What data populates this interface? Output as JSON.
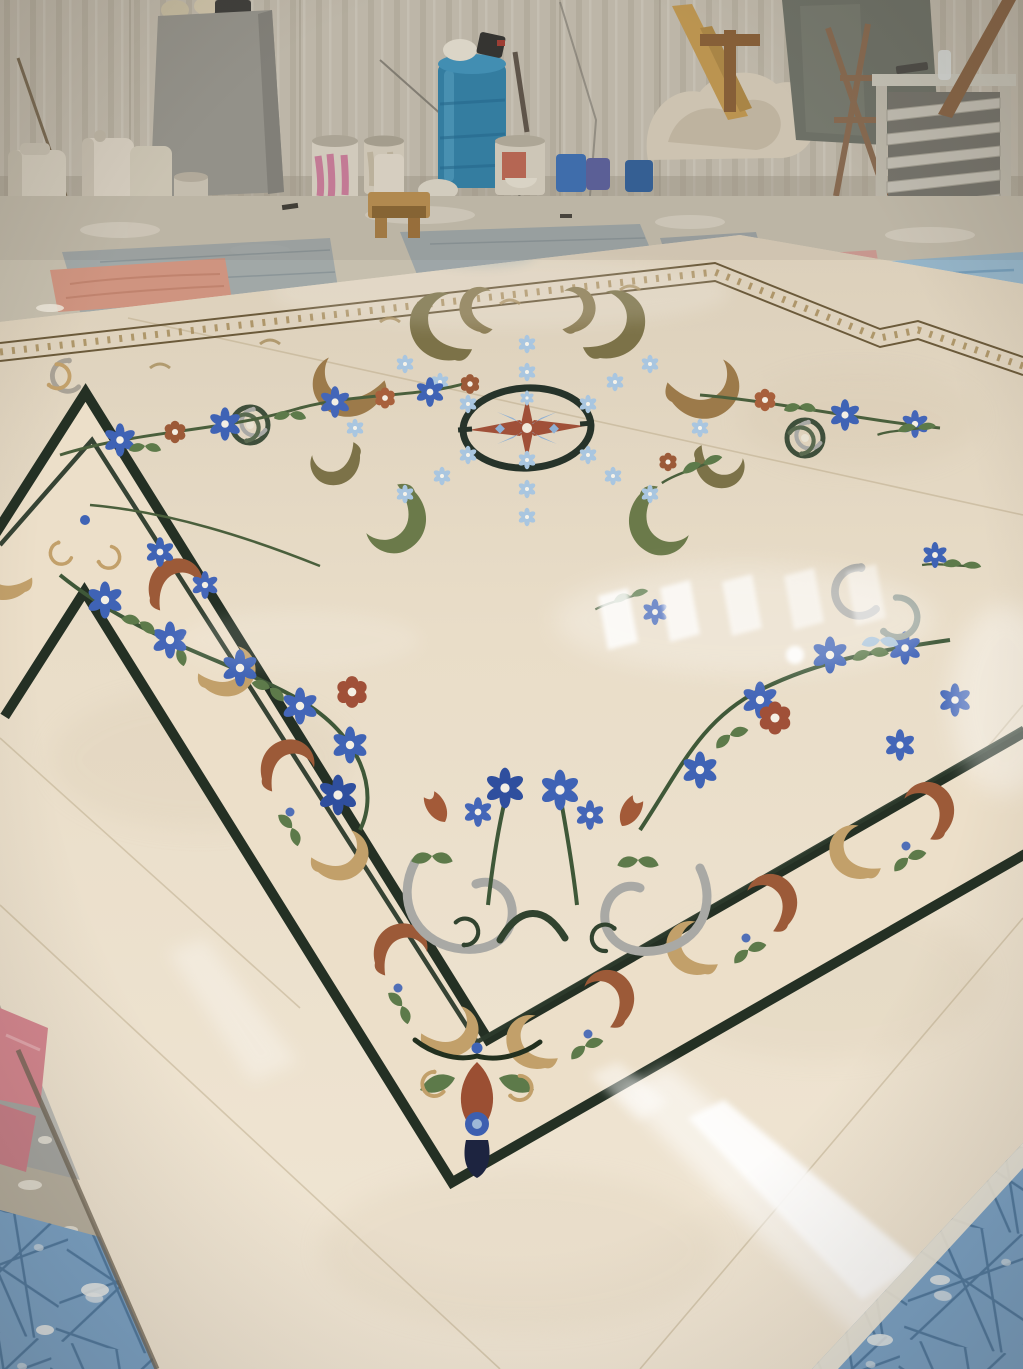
{
  "meta": {
    "domain": "photograph",
    "title": "Waterjet marble inlay medallion floor in a stone workshop",
    "description": "A large freshly polished crema-marfil marble floor with an ornate waterjet inlay — a stepped dark-green border frame filled with rust and tan acanthus scrolls, a central compass medallion ringed by an olive scroll wreath with pale blue rosettes, and a floral garland of blue daisies, rust flowers and gray baroque scrolls. The slab reflects overhead windows. Around it is a dusty workshop: corrugated sheet walls, a concrete slab, white jerry cans, paint buckets with pink drips, a blue plastic barrel, a wooden stool, lumber, a steel drying rack, gray quilted mats, a salmon cushion, light blue and pink cloths, blue cross-hatched protective tarps and pink foam sheets at the slab edges."
  },
  "scene": {
    "setting": "marble fabrication workshop",
    "objects": [
      "corrugated-wall",
      "concrete-slab",
      "white-jerry-cans",
      "paint-bucket-pink-drips",
      "blue-plastic-barrel",
      "red-label-bucket",
      "blue-bucket",
      "purple-bucket",
      "blue-jerry-can",
      "white-bowl",
      "cloth-pile",
      "wooden-plank-ladder",
      "dark-stone-slabs",
      "rusty-trestle",
      "steel-drying-rack",
      "water-bottle",
      "wooden-stool",
      "salmon-cushion",
      "gray-quilted-mats",
      "pink-cloth",
      "light-blue-tarp",
      "blue-crosshatch-tarp",
      "pink-foam-sheets",
      "marble-floor"
    ],
    "floor_design": {
      "type": "waterjet marble inlay medallion",
      "field_stone": "crema marfil (cream beige)",
      "elements": [
        "thin tan scroll border near far edge with stepped jog",
        "wide stepped frame of dark green lines filled with rust and tan acanthus",
        "corner drop ornament with navy tassel and blue ring flower",
        "central dark ring medallion with rust compass star",
        "olive acanthus wreath with pale blue rosettes",
        "floral garland with blue daisies, rust flowers, green vines",
        "gray baroque C-scroll cluster with upright flower stems",
        "scattered flower sprigs",
        "bright window reflections on polish"
      ]
    }
  },
  "palette": {
    "wall": "#c7c0b1",
    "wall_stripe": "#b2ab9b",
    "concrete_slab": "#98978f",
    "workshop_floor": "#c6bfae",
    "marble_mid": "#e9ddc8",
    "marble_far": "#d8ccb7",
    "marble_near": "#f2e8d7",
    "inlay_dark": "#243024",
    "band_cream": "#ecdfc9",
    "tan": "#c2a06a",
    "rust": "#9c5a38",
    "olive": "#7c7248",
    "leaf_green": "#5d7a4a",
    "vine_green": "#3f5838",
    "daisy_blue": "#3f63b5",
    "pale_blue": "#a9c6e0",
    "gray_scroll": "#a9a9a5",
    "navy": "#1d2440",
    "barrel_blue": "#2e80a9",
    "tarp_blue": "#7aa3c8",
    "tarp_line": "#3a658f",
    "cloth_salmon": "#cf9480",
    "foam_pink": "#d4868f",
    "wood": "#b98e4e"
  }
}
